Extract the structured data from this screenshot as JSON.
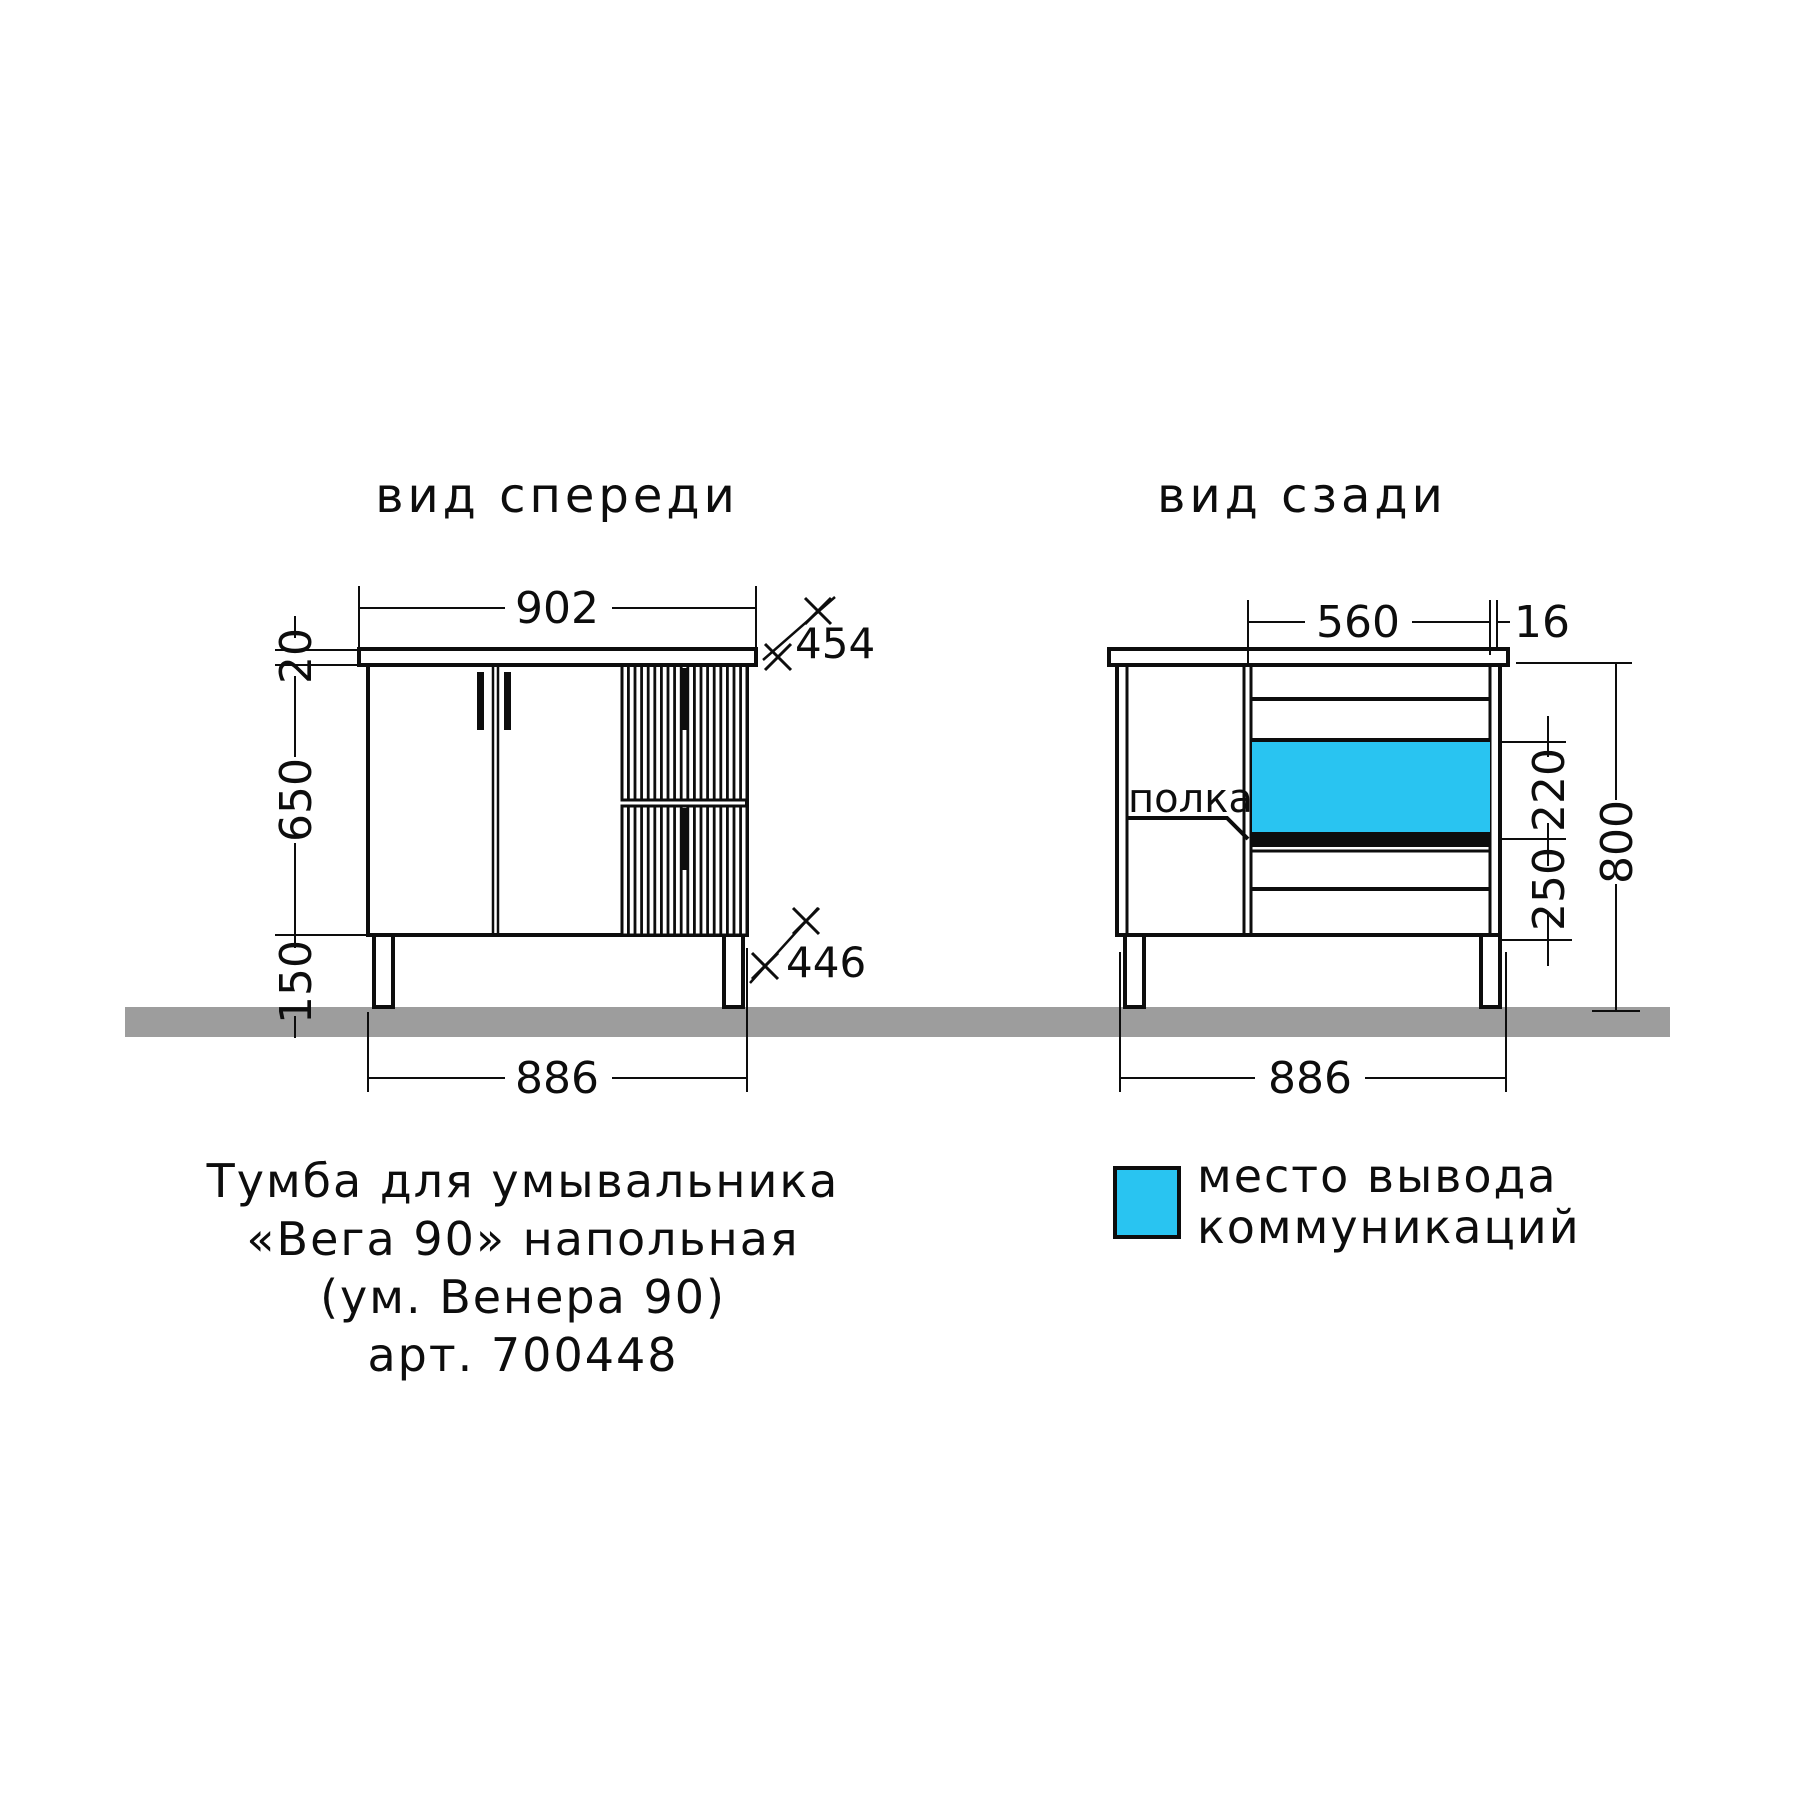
{
  "front_view": {
    "title": "вид спереди",
    "dim_width_top": "902",
    "dim_top_thickness": "20",
    "dim_body_height": "650",
    "dim_leg_height": "150",
    "dim_width_bottom": "886",
    "dim_depth_top": "454",
    "dim_depth_body": "446"
  },
  "back_view": {
    "title": "вид сзади",
    "dim_opening_width": "560",
    "dim_panel_thickness": "16",
    "dim_outlet_zone_height": "220",
    "dim_lower_zone_height": "250",
    "dim_total_height": "800",
    "dim_width_bottom": "886",
    "shelf_label": "полка"
  },
  "caption": {
    "line1": "Тумба для умывальника",
    "line2": "«Вега 90» напольная",
    "line3": "(ум. Венера 90)",
    "line4": "арт. 700448"
  },
  "legend": {
    "label_line1": "место вывода",
    "label_line2": "коммуникаций"
  },
  "colors": {
    "line": "#0d0d0d",
    "ground": "#9d9d9d",
    "outlet_cyan": "#29c4f1"
  }
}
